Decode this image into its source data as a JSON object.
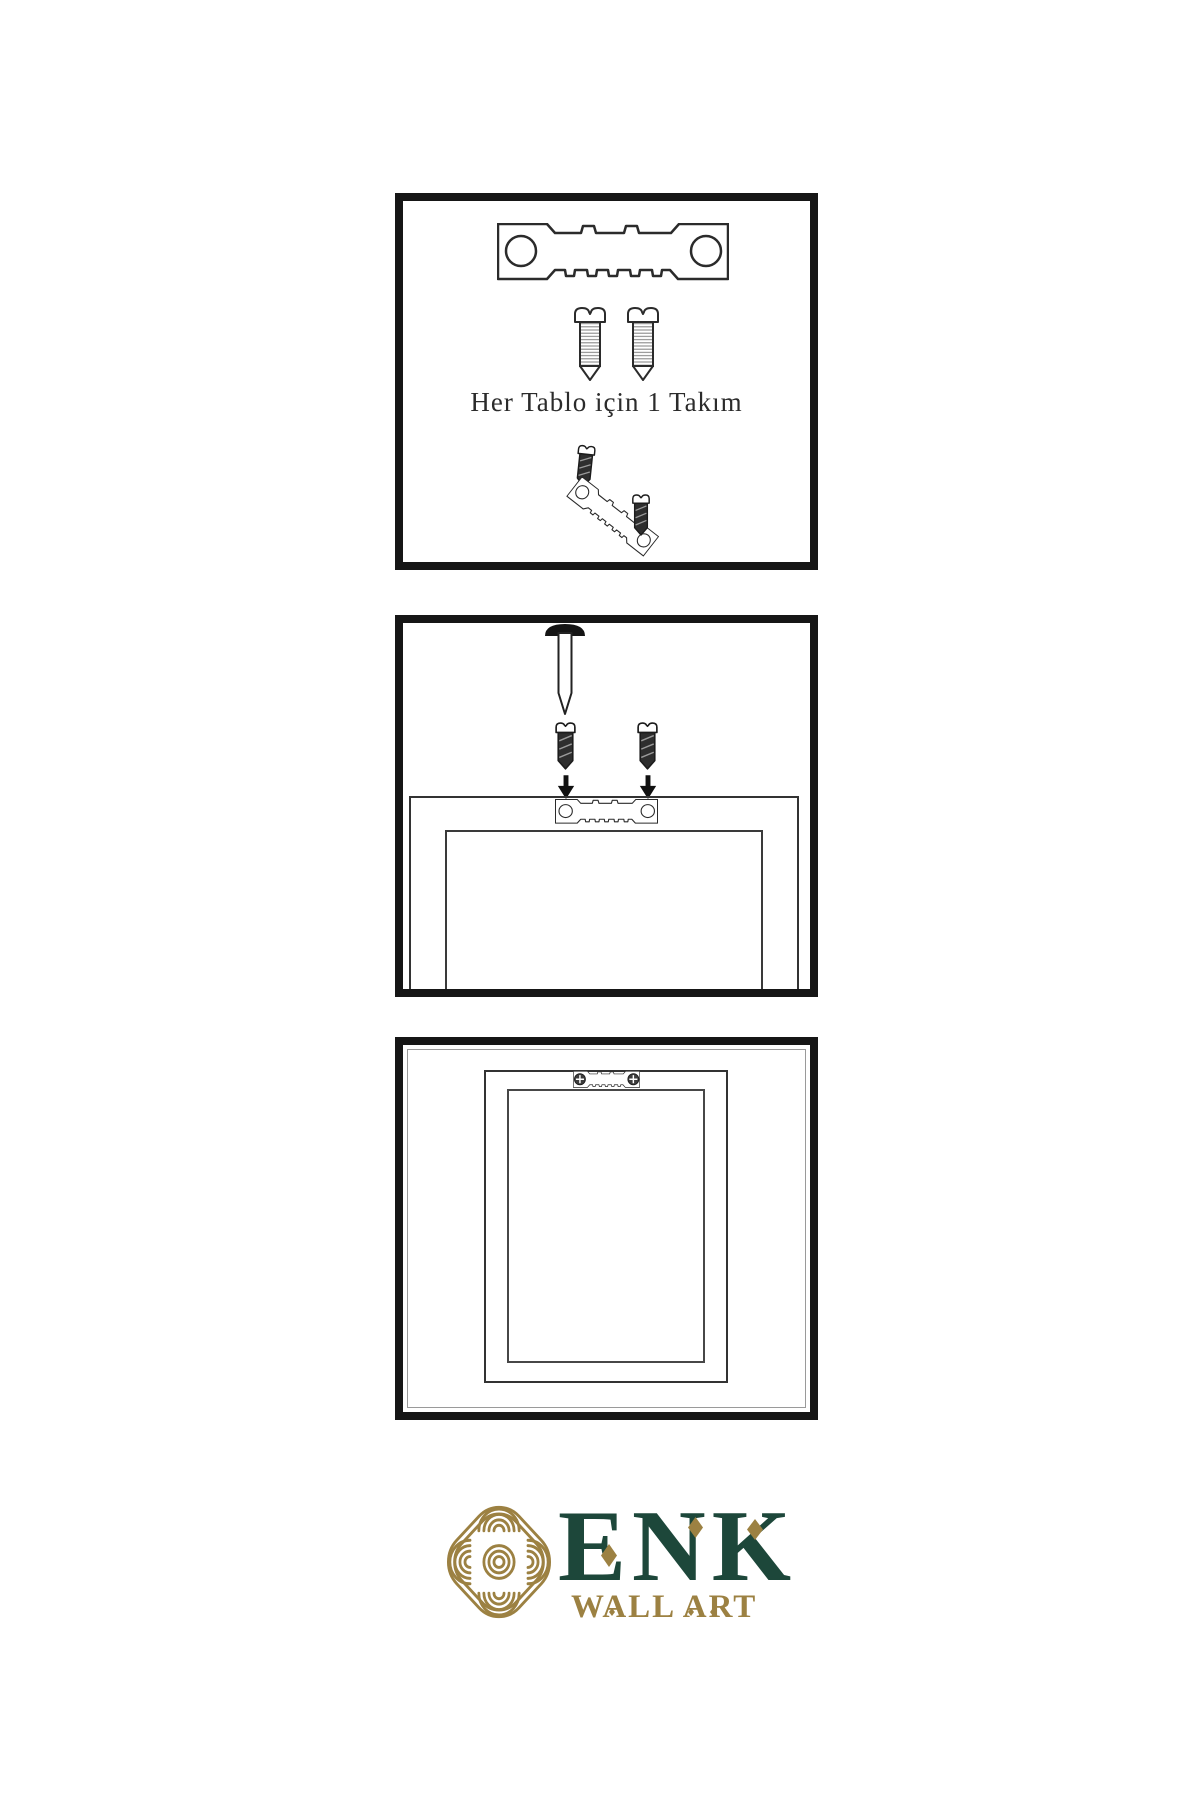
{
  "page": {
    "background": "#ffffff",
    "line_color": "#161616"
  },
  "panel1": {
    "name": "hardware-kit",
    "caption": "Her Tablo için 1 Takım",
    "contents": [
      "sawtooth-hanger",
      "screw",
      "screw",
      "tilted-screw",
      "tilted-sawtooth-hanger",
      "screw"
    ]
  },
  "panel2": {
    "name": "installation-step",
    "contents": [
      "wall-nail",
      "screw-with-arrow",
      "screw-with-arrow",
      "frame-back",
      "sawtooth-hanger-mounted"
    ]
  },
  "panel3": {
    "name": "hung-frame-step",
    "contents": [
      "framed-art-back",
      "sawtooth-hanger-with-screws"
    ]
  },
  "brand": {
    "name": "ENK",
    "tagline": "WALL ART",
    "green": "#1d473a",
    "gold": "#9c8142",
    "logo_icon": "celtic-knot"
  },
  "icons": {
    "hanger": "sawtooth-hanger-icon",
    "screw_light": "screw-icon",
    "screw_dark": "dark-screw-icon",
    "nail": "wall-nail-icon",
    "arrow": "arrow-down-icon",
    "knot": "celtic-knot-logo-icon"
  }
}
